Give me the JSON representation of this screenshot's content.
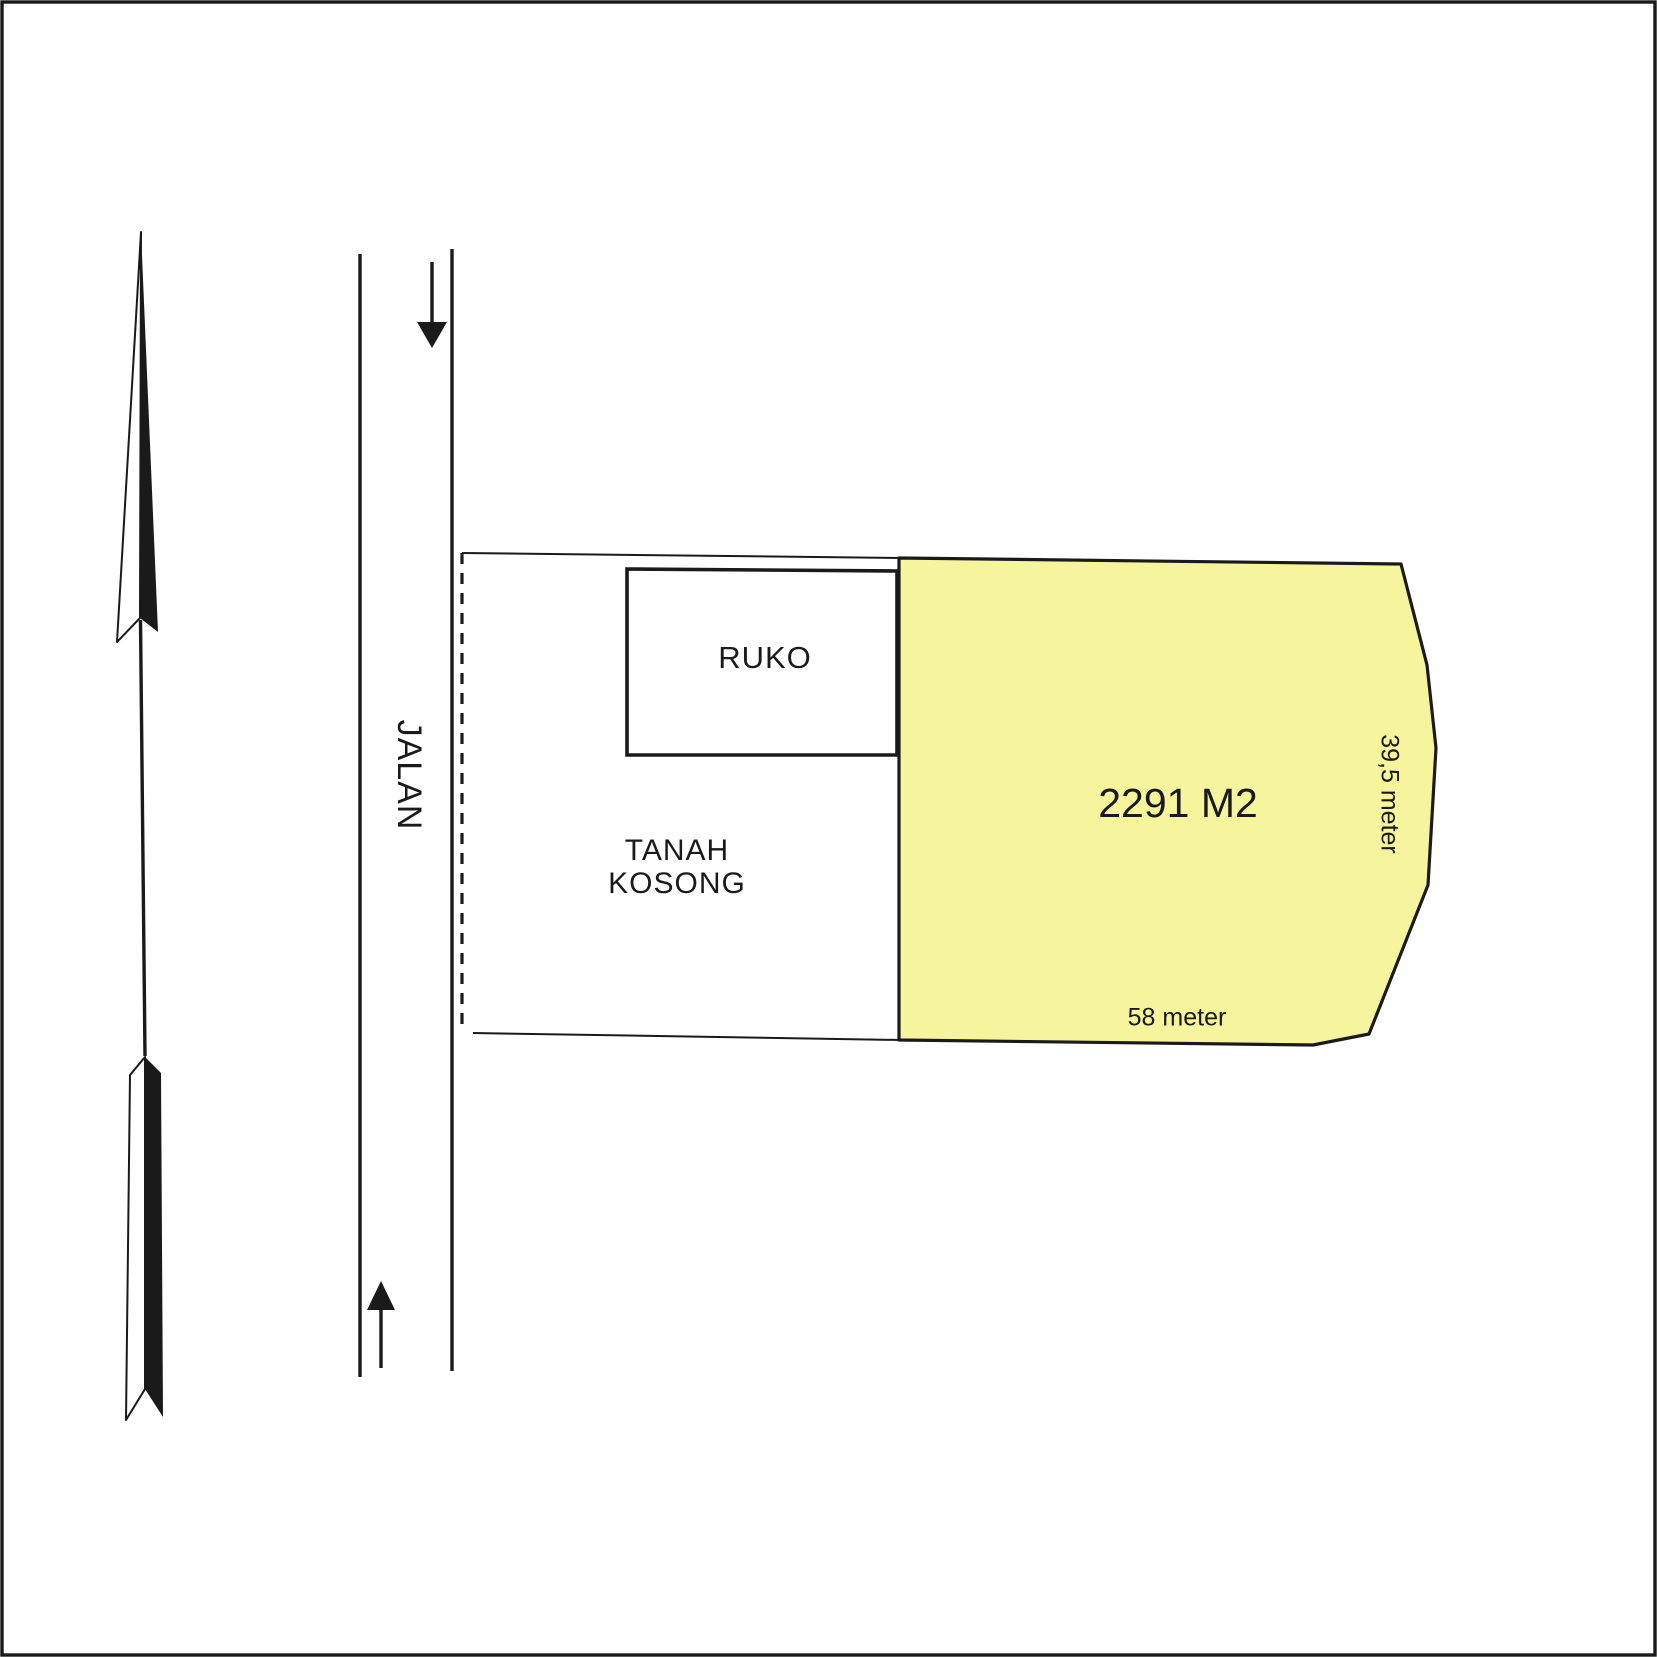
{
  "diagram": {
    "road": {
      "label": "JALAN",
      "direction_arrow_top": "down",
      "direction_arrow_bottom": "up"
    },
    "compass": {
      "meaning": "north-arrow"
    },
    "ruko": {
      "label": "RUKO"
    },
    "vacant_land": {
      "label_line1": "TANAH",
      "label_line2": "KOSONG"
    },
    "parcel": {
      "area_label": "2291 M2",
      "bottom_dimension": "58 meter",
      "right_dimension": "39,5 meter"
    }
  },
  "colors": {
    "line": "#1a1a1a",
    "parcel_fill": "#f6f59e",
    "background": "#ffffff"
  }
}
